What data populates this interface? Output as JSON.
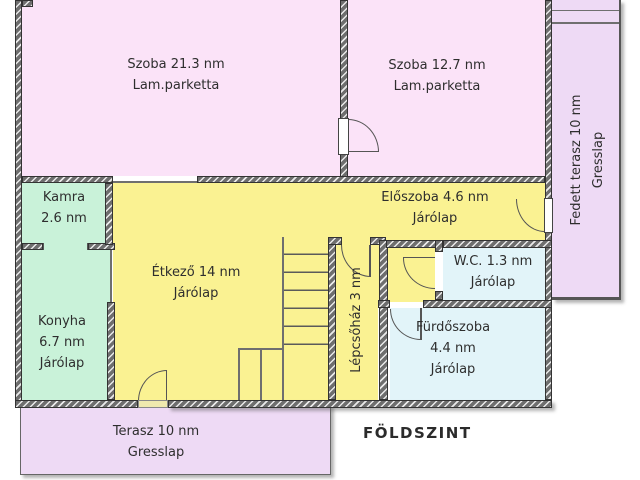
{
  "floor_title": "FÖLDSZINT",
  "rooms": {
    "szoba1": {
      "label": "Szoba 21.3 nm",
      "floor": "Lam.parketta"
    },
    "szoba2": {
      "label": "Szoba 12.7 nm",
      "floor": "Lam.parketta"
    },
    "fedett_terasz": {
      "label": "Fedett terasz 10 nm",
      "floor": "Gresslap"
    },
    "kamra": {
      "label": "Kamra",
      "area": "2.6 nm"
    },
    "konyha": {
      "label": "Konyha",
      "area": "6.7 nm",
      "floor": "Járólap"
    },
    "etkezo": {
      "label": "Étkező 14 nm",
      "floor": "Járólap"
    },
    "eloszoba": {
      "label": "Előszoba 4.6 nm",
      "floor": "Járólap"
    },
    "wc": {
      "label": "W.C. 1.3 nm",
      "floor": "Járólap"
    },
    "furdoszoba": {
      "label": "Fürdőszoba",
      "area": "4.4 nm",
      "floor": "Járólap"
    },
    "lepcsohaz": {
      "label": "Lépcsőház 3 nm"
    },
    "terasz": {
      "label": "Terasz 10 nm",
      "floor": "Gresslap"
    }
  },
  "colors": {
    "room_pink": "#fbe3f8",
    "terrace_lavender": "#eedaf5",
    "living_yellow": "#faf292",
    "kitchen_green": "#c9f2d9",
    "bath_blue": "#e2f4f9",
    "wall_gray": "#6e6e6e"
  }
}
